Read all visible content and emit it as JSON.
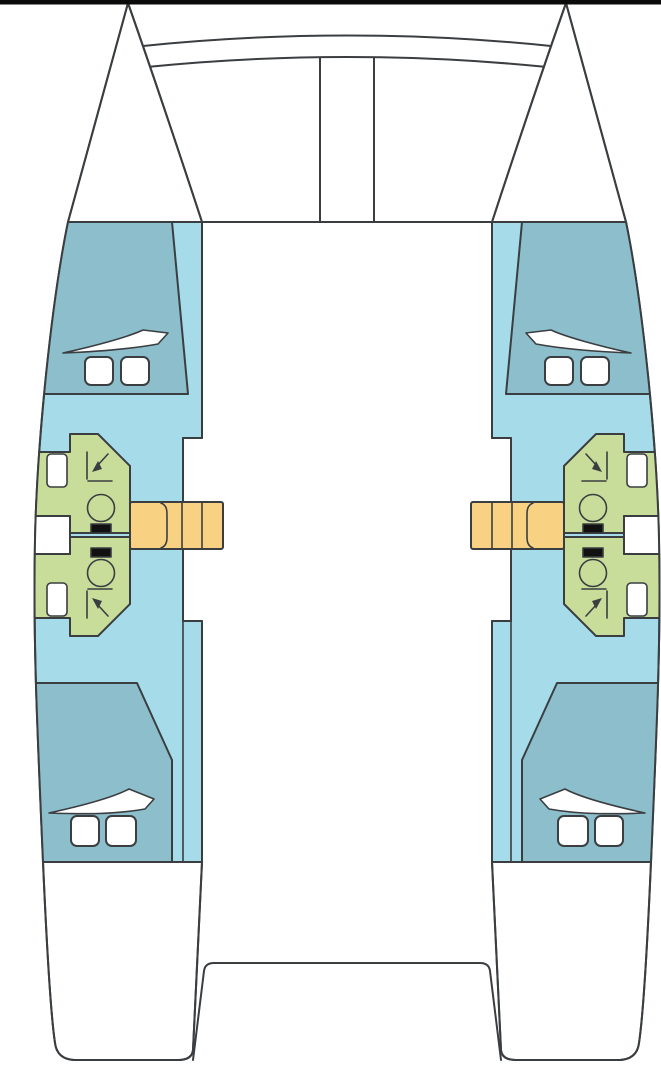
{
  "diagram": {
    "type": "catamaran-deck-plan",
    "view": "top-down",
    "hull_count": 2,
    "cabin_count": 4,
    "bathroom_count": 4,
    "companionway_count": 2,
    "regions": {
      "port_hull": "port-hull",
      "starboard_hull": "starboard-hull",
      "forward_cabin": "forward-cabin-berth",
      "aft_cabin": "aft-cabin-berth",
      "forward_bathroom": "forward-bathroom",
      "aft_bathroom": "aft-bathroom",
      "companionway": "companionway-steps",
      "bow_crossbeam": "bow-crossbeam",
      "center_spar": "center-longitudinal-beam",
      "bridge_deck": "bridge-deck",
      "stern_platform": "stern-cockpit-platform"
    },
    "fixtures_per_bathroom": [
      "toilet",
      "sink",
      "shower-corner-symbol"
    ],
    "hatches_per_cabin": 2
  },
  "palette": {
    "background": "#ffffff",
    "outline": "#3a3e41",
    "top_bar": "#0b0b0b",
    "cabin": "#8cbecb",
    "sole": "#a6dcea",
    "bathroom": "#c9dd9a",
    "steps": "#f8d183",
    "fixture_white": "#ffffff",
    "toilet_tank": "#111111"
  }
}
